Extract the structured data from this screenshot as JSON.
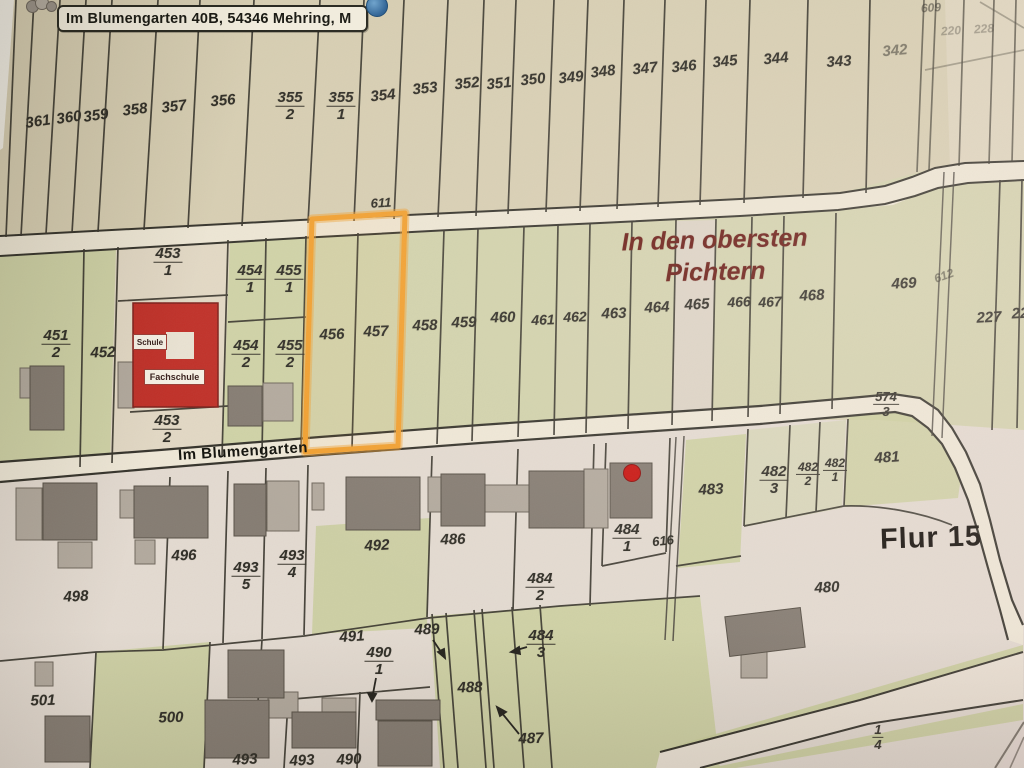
{
  "app": {
    "address_label": "Im Blumengarten 40B, 54346 Mehring, M"
  },
  "map": {
    "region_title_line1": "In den obersten",
    "region_title_line2": "Pichtern",
    "street_label": "Im Blumengarten",
    "flur_label": "Flur 15",
    "school": {
      "schule": "Schule",
      "fachschule": "Fachschule"
    },
    "highlight_color": "#f1a030",
    "marker_color": "#c81410",
    "highlighted_parcels": [
      "456",
      "457"
    ],
    "labels": [
      {
        "t": "361",
        "x": 38,
        "y": 122,
        "r": -8
      },
      {
        "t": "360",
        "x": 69,
        "y": 118,
        "r": -8
      },
      {
        "t": "359",
        "x": 96,
        "y": 116,
        "r": -8
      },
      {
        "t": "358",
        "x": 135,
        "y": 110,
        "r": -7
      },
      {
        "t": "357",
        "x": 174,
        "y": 107,
        "r": -7
      },
      {
        "t": "356",
        "x": 223,
        "y": 101,
        "r": -5
      },
      {
        "n": "355",
        "d": "2",
        "x": 290,
        "y": 106
      },
      {
        "n": "355",
        "d": "1",
        "x": 341,
        "y": 106
      },
      {
        "t": "354",
        "x": 383,
        "y": 96,
        "r": -6
      },
      {
        "t": "353",
        "x": 425,
        "y": 89,
        "r": -6
      },
      {
        "t": "352",
        "x": 467,
        "y": 84,
        "r": -6
      },
      {
        "t": "351",
        "x": 499,
        "y": 84,
        "r": -6
      },
      {
        "t": "350",
        "x": 533,
        "y": 80,
        "r": -6
      },
      {
        "t": "349",
        "x": 571,
        "y": 78,
        "r": -6
      },
      {
        "t": "348",
        "x": 603,
        "y": 72,
        "r": -7
      },
      {
        "t": "347",
        "x": 645,
        "y": 69,
        "r": -6
      },
      {
        "t": "346",
        "x": 684,
        "y": 67,
        "r": -6
      },
      {
        "t": "345",
        "x": 725,
        "y": 62,
        "r": -6
      },
      {
        "t": "344",
        "x": 776,
        "y": 59,
        "r": -6
      },
      {
        "t": "343",
        "x": 839,
        "y": 62,
        "r": -4
      },
      {
        "t": "342",
        "x": 895,
        "y": 51,
        "r": -5,
        "c": "dim"
      },
      {
        "t": "609",
        "x": 931,
        "y": 8,
        "r": -4,
        "c": "dim sm"
      },
      {
        "t": "220",
        "x": 951,
        "y": 31,
        "r": -4,
        "c": "dim2 sm"
      },
      {
        "t": "228",
        "x": 984,
        "y": 29,
        "r": -4,
        "c": "dim2 sm"
      },
      {
        "n": "451",
        "d": "2",
        "x": 56,
        "y": 344
      },
      {
        "t": "452",
        "x": 103,
        "y": 353,
        "r": -2
      },
      {
        "n": "453",
        "d": "1",
        "x": 168,
        "y": 262
      },
      {
        "n": "454",
        "d": "1",
        "x": 250,
        "y": 279
      },
      {
        "n": "455",
        "d": "1",
        "x": 289,
        "y": 279
      },
      {
        "n": "454",
        "d": "2",
        "x": 246,
        "y": 354
      },
      {
        "n": "455",
        "d": "2",
        "x": 290,
        "y": 354
      },
      {
        "n": "453",
        "d": "2",
        "x": 167,
        "y": 429
      },
      {
        "t": "456",
        "x": 332,
        "y": 335,
        "r": -2
      },
      {
        "t": "457",
        "x": 376,
        "y": 332,
        "r": -2
      },
      {
        "t": "458",
        "x": 425,
        "y": 326,
        "r": -2
      },
      {
        "t": "459",
        "x": 464,
        "y": 323,
        "r": -2
      },
      {
        "t": "460",
        "x": 503,
        "y": 318,
        "r": -2
      },
      {
        "t": "461",
        "x": 543,
        "y": 320,
        "r": -2,
        "s": 14
      },
      {
        "t": "462",
        "x": 575,
        "y": 317,
        "r": -2,
        "s": 14
      },
      {
        "t": "463",
        "x": 614,
        "y": 314,
        "r": -2
      },
      {
        "t": "464",
        "x": 657,
        "y": 308,
        "r": -3
      },
      {
        "t": "465",
        "x": 697,
        "y": 305,
        "r": -3
      },
      {
        "t": "466",
        "x": 739,
        "y": 302,
        "r": -3,
        "s": 14
      },
      {
        "t": "467",
        "x": 770,
        "y": 302,
        "r": -3,
        "s": 14
      },
      {
        "t": "468",
        "x": 812,
        "y": 296,
        "r": -3
      },
      {
        "t": "469",
        "x": 904,
        "y": 284,
        "r": -3
      },
      {
        "t": "612",
        "x": 944,
        "y": 276,
        "r": -20,
        "c": "dim sm"
      },
      {
        "t": "227",
        "x": 989,
        "y": 318,
        "r": -3
      },
      {
        "t": "22",
        "x": 1020,
        "y": 314,
        "r": -3
      },
      {
        "t": "611",
        "x": 381,
        "y": 203,
        "r": -3,
        "s": 13
      },
      {
        "n": "574",
        "d": "3",
        "x": 886,
        "y": 404,
        "s": 13
      },
      {
        "t": "498",
        "x": 76,
        "y": 597,
        "r": -3
      },
      {
        "t": "496",
        "x": 184,
        "y": 556,
        "r": -2
      },
      {
        "n": "493",
        "d": "5",
        "x": 246,
        "y": 576
      },
      {
        "n": "493",
        "d": "4",
        "x": 292,
        "y": 564
      },
      {
        "t": "492",
        "x": 377,
        "y": 546,
        "r": -3
      },
      {
        "t": "486",
        "x": 453,
        "y": 540,
        "r": -2
      },
      {
        "n": "484",
        "d": "2",
        "x": 540,
        "y": 587
      },
      {
        "n": "484",
        "d": "1",
        "x": 627,
        "y": 538
      },
      {
        "t": "616",
        "x": 663,
        "y": 541,
        "r": -6,
        "s": 13
      },
      {
        "t": "483",
        "x": 711,
        "y": 490,
        "r": -3
      },
      {
        "n": "482",
        "d": "3",
        "x": 774,
        "y": 480
      },
      {
        "n": "482",
        "d": "2",
        "x": 808,
        "y": 474,
        "s": 12
      },
      {
        "n": "482",
        "d": "1",
        "x": 835,
        "y": 470,
        "s": 12
      },
      {
        "t": "481",
        "x": 887,
        "y": 458,
        "r": -4
      },
      {
        "t": "480",
        "x": 827,
        "y": 588,
        "r": -3
      },
      {
        "n": "484",
        "d": "3",
        "x": 541,
        "y": 644
      },
      {
        "t": "489",
        "x": 427,
        "y": 630,
        "r": -2
      },
      {
        "t": "488",
        "x": 470,
        "y": 688,
        "r": -2
      },
      {
        "t": "487",
        "x": 531,
        "y": 739,
        "r": -2
      },
      {
        "t": "491",
        "x": 352,
        "y": 637,
        "r": -4
      },
      {
        "n": "490",
        "d": "1",
        "x": 379,
        "y": 661
      },
      {
        "t": "501",
        "x": 43,
        "y": 701,
        "r": -2
      },
      {
        "t": "500",
        "x": 171,
        "y": 718,
        "r": -2
      },
      {
        "t": "493",
        "x": 245,
        "y": 760,
        "r": -3
      },
      {
        "t": "493",
        "x": 302,
        "y": 761,
        "r": -3
      },
      {
        "t": "490",
        "x": 349,
        "y": 760,
        "r": -3
      },
      {
        "n": "1",
        "d": "4",
        "x": 878,
        "y": 737,
        "s": 13
      }
    ]
  }
}
